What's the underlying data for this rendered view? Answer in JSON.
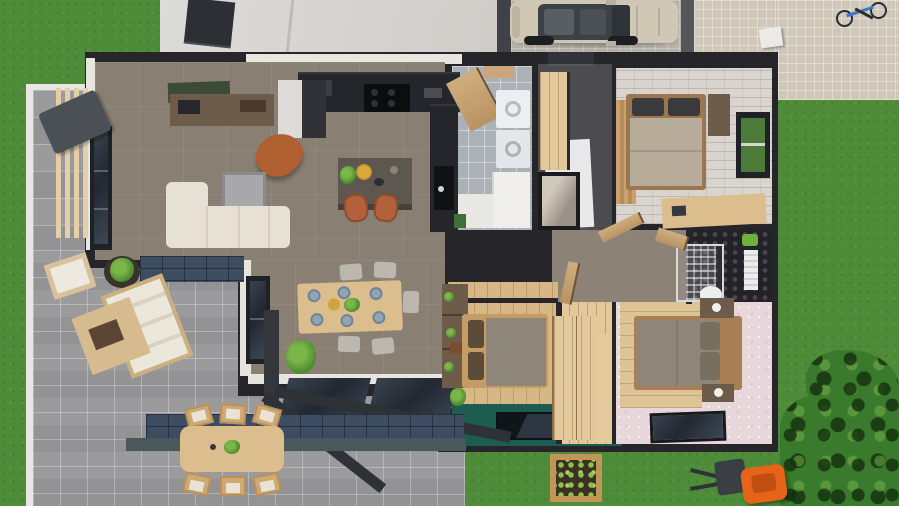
{
  "meta": {
    "title": "3D top-down floor plan rendering of a single-storey house",
    "view": "top-down cutaway",
    "style": "photorealistic architectural visualization"
  },
  "palette": {
    "grass": "#4f8c3a",
    "tree_foliage": "#3a7a2c",
    "paver_gray": "#a7a7a9",
    "paver_beige": "#cfc7b8",
    "driveway_concrete": "#b6b1a9",
    "roof_slab": "#d8d6d3",
    "skylight_dark": "#2c2f33",
    "wall_dark": "#26262a",
    "wall_cap_white": "#e8e6e1",
    "floor_taupe": "#8a7f73",
    "floor_tile_gray": "#abb1b6",
    "floor_brick_white": "#d9d5ce",
    "floor_hex_dark": "#232327",
    "floor_wood": "#d8b787",
    "floor_teal": "#1d5c51",
    "floor_pink": "#e8d7da",
    "counter_dark": "#25262b",
    "island_top": "#5d574f",
    "sofa_cream": "#e7e1d5",
    "accent_leather_orange": "#b06030",
    "dining_wood": "#dcbd8d",
    "plate_blue": "#8fa5b5",
    "glass_dark": "#2b3440",
    "blue_tile_strip": "#3d4c61",
    "car_champagne": "#d0c7b5",
    "mower_orange": "#e56418",
    "planter_wood": "#c19557",
    "lettuce_green": "#8cc04a"
  },
  "rooms": {
    "living": {
      "label": "Living room"
    },
    "kitchen": {
      "label": "Kitchen"
    },
    "dining": {
      "label": "Dining area"
    },
    "utility": {
      "label": "Utility / laundry room"
    },
    "entry": {
      "label": "Entry hall"
    },
    "bedroom1": {
      "label": "Bedroom 1 (top right)"
    },
    "bathroom": {
      "label": "Bathroom with hex tile"
    },
    "hallway": {
      "label": "Hallway"
    },
    "bedroom2": {
      "label": "Bedroom 2 (middle)"
    },
    "closet": {
      "label": "Wardrobe corridor"
    },
    "bedroom3": {
      "label": "Bedroom 3 (pink)"
    },
    "patio": {
      "label": "Paved pergola patio"
    },
    "walkway": {
      "label": "Side pergola walkway"
    },
    "driveway": {
      "label": "Carport driveway"
    },
    "garden": {
      "label": "Garden lawn"
    }
  },
  "furniture": {
    "living": [
      "corner sofa",
      "coffee table",
      "TV console",
      "wall artwork",
      "leather armchair",
      "window"
    ],
    "kitchen": [
      "worktop with cooktop",
      "tall cabinet",
      "kitchen island",
      "two bar stools",
      "sink counter",
      "fruit plate",
      "potted herb"
    ],
    "dining": [
      "wooden dining table",
      "six chairs",
      "six blue plates",
      "centerpiece plant",
      "corner plant",
      "bookshelf divider",
      "sliding glass doors"
    ],
    "utility": [
      "washing machine",
      "dryer",
      "cabinet",
      "open wooden door",
      "counter"
    ],
    "entry": [
      "wardrobe",
      "mirror cabinet",
      "front door",
      "white rug"
    ],
    "bedroom1": [
      "double bed",
      "dark pillows",
      "side shelf",
      "desk",
      "garden window",
      "wood slat wall"
    ],
    "bathroom": [
      "glass shower",
      "towel radiator",
      "toilet",
      "plant",
      "wooden door"
    ],
    "bedroom2": [
      "double bed",
      "brown pillows",
      "wardrobe",
      "teal floor zone",
      "floor window"
    ],
    "bedroom3": [
      "double bed",
      "two nightstands with lamps",
      "bottom wall window"
    ],
    "patio": [
      "outdoor lounge bench",
      "lounge chair",
      "potted plant",
      "coffee mat with tray",
      "outdoor dining table",
      "six patio chairs",
      "pergola post",
      "pergola beams"
    ]
  },
  "exterior": {
    "items": [
      "champagne SUV",
      "bicycle",
      "white bench",
      "raised planter box with lettuce",
      "orange lawn mower",
      "tree canopy",
      "dark patio chair",
      "paver driveway",
      "blue tile plinth strip"
    ]
  }
}
